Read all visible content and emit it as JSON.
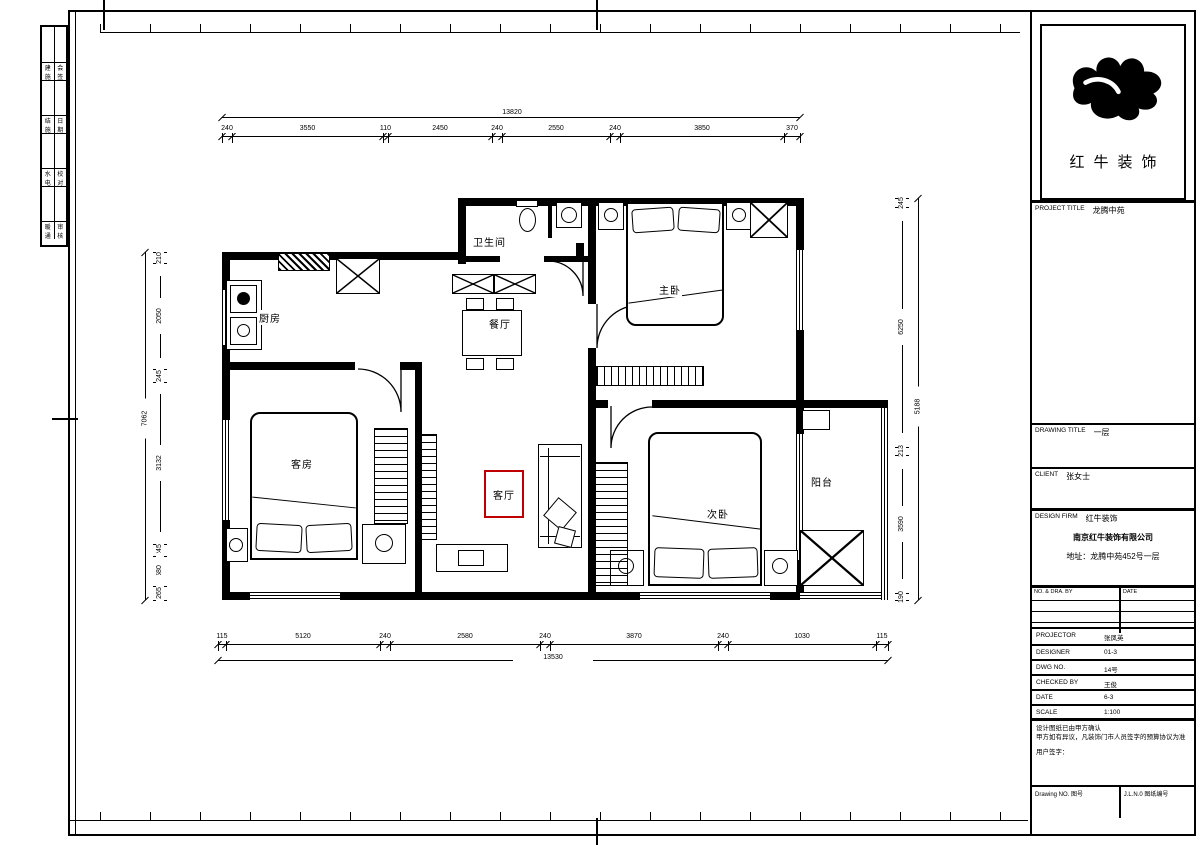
{
  "logo": {
    "name": "红牛装饰"
  },
  "title_block": {
    "project_title_label": "PROJECT TITLE",
    "project_title_value": "龙腾中苑",
    "drawing_title_label": "DRAWING TITLE",
    "drawing_title_value": "一层",
    "client_label": "CLIENT",
    "client_value": "张女士",
    "design_firm_label": "DESIGN FIRM",
    "design_firm_value": "红牛装饰",
    "company_name": "南京红牛装饰有限公司",
    "company_address": "地址：龙腾中苑452号一层",
    "log_header_left": "NO. & DRA. BY",
    "log_header_right": "DATE",
    "fields": [
      {
        "label": "PROJECTOR",
        "value": "张凤英"
      },
      {
        "label": "DESIGNER",
        "value": "01-3"
      },
      {
        "label": "DWG NO.",
        "value": "14号"
      },
      {
        "label": "CHECKED BY",
        "value": "王俊"
      },
      {
        "label": "DATE",
        "value": "6-3"
      },
      {
        "label": "SCALE",
        "value": "1:100"
      }
    ],
    "notes": [
      "设计图纸已由甲方确认",
      "甲方如有异议，凡装饰门市人员签字的预算协议为准",
      "用户签字："
    ],
    "footer_left": "Drawing NO. 图号",
    "footer_right": "J.L.N.0 图纸编号"
  },
  "sign_table": {
    "rows": [
      [
        "建施",
        "会签"
      ],
      [
        "结施",
        "日期"
      ],
      [
        "水电",
        "校对"
      ],
      [
        "暖通",
        "审核"
      ]
    ]
  },
  "plan": {
    "rooms": [
      {
        "id": "bathroom",
        "label": "卫生间"
      },
      {
        "id": "dining",
        "label": "餐厅"
      },
      {
        "id": "master",
        "label": "主卧"
      },
      {
        "id": "kitchen",
        "label": "厨房"
      },
      {
        "id": "guest",
        "label": "客房"
      },
      {
        "id": "living",
        "label": "客厅",
        "highlight": true
      },
      {
        "id": "second",
        "label": "次卧"
      },
      {
        "id": "balcony",
        "label": "阳台"
      }
    ],
    "highlight_color": "#c00000"
  },
  "dims": {
    "top": {
      "overall": "13820",
      "segments": [
        "240",
        "3550",
        "110",
        "2450",
        "240",
        "2550",
        "240",
        "3850",
        "370"
      ]
    },
    "bottom": {
      "overall": "13530",
      "segments": [
        "115",
        "5120",
        "240",
        "2580",
        "240",
        "3870",
        "240",
        "1030",
        "115"
      ]
    },
    "left": {
      "overall": "7062",
      "segments": [
        "210",
        "2050",
        "245",
        "3132",
        "245",
        "580",
        "265"
      ]
    },
    "right": {
      "overall": "5188",
      "segments": [
        "245",
        "6250",
        "213",
        "3590",
        "190"
      ]
    }
  },
  "colors": {
    "line": "#000000",
    "paper": "#ffffff",
    "highlight": "#c00000"
  }
}
